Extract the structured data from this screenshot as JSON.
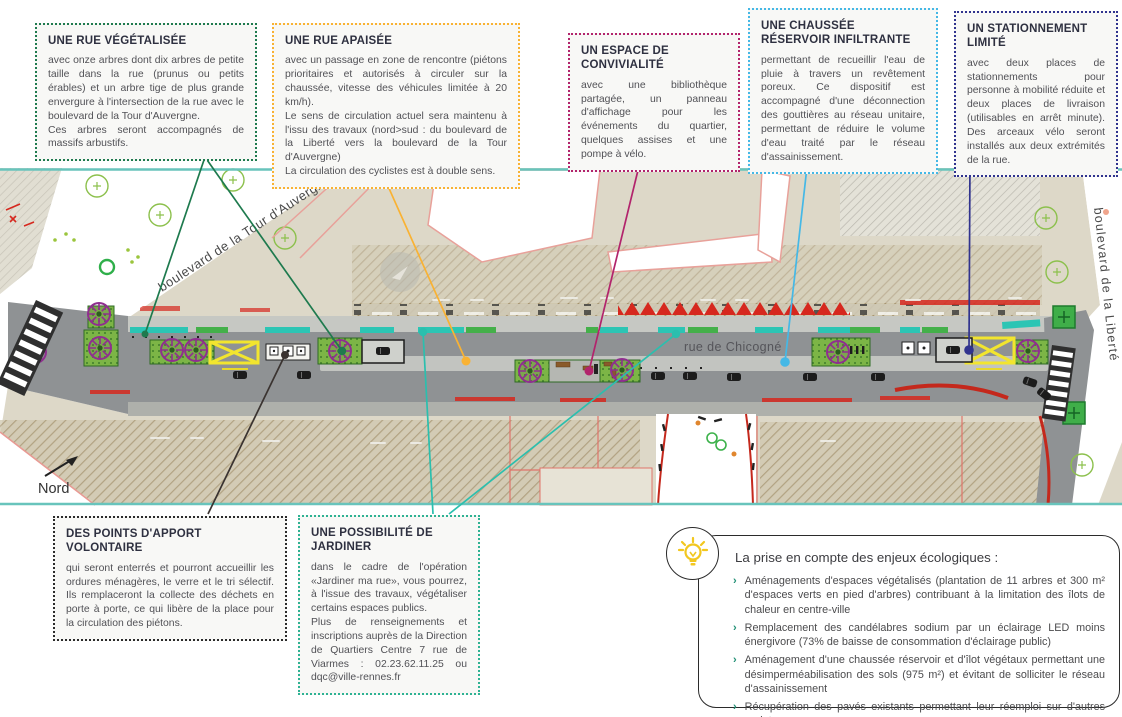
{
  "document_title": "Plan d'aménagement rue de Chicogné",
  "callouts": {
    "vegetalisee": {
      "title": "UNE RUE VÉGÉTALISÉE",
      "body": "avec onze arbres dont dix arbres de petite taille dans la rue (prunus ou petits érables) et un arbre tige de plus grande envergure à l'intersection de la rue avec le boulevard de la Tour d'Auvergne.\nCes arbres seront accompagnés de massifs arbustifs."
    },
    "apaisee": {
      "title": "UNE RUE APAISÉE",
      "body": "avec un passage en zone de rencontre (piétons prioritaires et autorisés à circuler sur la chaussée, vitesse des véhicules limitée à 20 km/h).\nLe sens de circulation actuel sera maintenu à l'issu des travaux (nord>sud : du boulevard de la Liberté vers la boulevard de la Tour d'Auvergne)\nLa circulation des cyclistes est à double sens."
    },
    "convivialite": {
      "title": "UN ESPACE DE CONVIVIALITÉ",
      "body": "avec une bibliothèque partagée, un panneau d'affichage pour les événements du quartier, quelques assises et une pompe à vélo."
    },
    "chaussee_reservoir": {
      "title": "UNE CHAUSSÉE RÉSERVOIR INFILTRANTE",
      "body": "permettant de recueillir l'eau de pluie à travers un revêtement poreux. Ce dispositif est accompagné d'une déconnection des gouttières au réseau unitaire, permettant de réduire le volume d'eau traité par le réseau d'assainissement."
    },
    "stationnement": {
      "title": "UN STATIONNEMENT LIMITÉ",
      "body": "avec deux places de stationnements pour personne à mobilité réduite et deux places de livraison (utilisables en arrêt minute). Des arceaux vélo seront installés aux deux extrémités de la rue."
    },
    "apport_volontaire": {
      "title": "DES POINTS D'APPORT VOLONTAIRE",
      "body": "qui seront enterrés et pourront accueillir les ordures ménagères, le verre et le tri sélectif. Ils remplaceront la collecte des déchets en porte à porte, ce qui libère de la place pour la circulation des piétons."
    },
    "jardiner": {
      "title": "UNE POSSIBILITÉ DE JARDINER",
      "body": "dans le cadre de l'opération «Jardiner ma rue», vous pourrez, à l'issue des travaux, végétaliser certains espaces publics.\nPlus de renseignements et inscriptions auprès de la Direction de Quartiers Centre 7 rue de Viarmes : 02.23.62.11.25 ou dqc@ville-rennes.fr"
    }
  },
  "eco_panel": {
    "title": "La prise en compte des enjeux écologiques :",
    "bullet_marker": "›",
    "bullets": [
      "Aménagements d'espaces végétalisés (plantation de 11 arbres et 300 m² d'espaces verts en pied d'arbres) contribuant à la limitation des îlots de chaleur en centre-ville",
      "Remplacement des candélabres sodium par un éclairage LED moins énergivore (73% de baisse de consommation d'éclairage public)",
      "Aménagement d'une chaussée réservoir et d'îlot végétaux permettant une désimperméabilisation des sols (975 m²) et évitant de solliciter le réseau d'assainissement",
      "Récupération des pavés existants permettant leur réemploi sur d'autres projets"
    ]
  },
  "map": {
    "street_label": "rue de Chicogné",
    "boulevard_west": "boulevard de la Tour d'Auvergne",
    "boulevard_east": "boulevard de la Liberté",
    "north_label": "Nord"
  },
  "colors": {
    "callout_vegetalisee": "#1e7a4e",
    "callout_apaisee": "#f9b233",
    "callout_convivialite": "#b2246c",
    "callout_chaussee": "#45b8e6",
    "callout_stationnement": "#30338e",
    "callout_apport": "#2b2b2b",
    "callout_jardiner": "#2eb293",
    "map_teal_curb": "#2cc5b4",
    "map_border_teal": "#68c4bc",
    "tree_purple": "#8f2f8f",
    "accent_red": "#d6281e",
    "road_gray": "#8f9294",
    "beige_block": "#ddd8c8",
    "highlight_yellow": "#f2e52e",
    "bulb_yellow": "#f2c71f"
  }
}
